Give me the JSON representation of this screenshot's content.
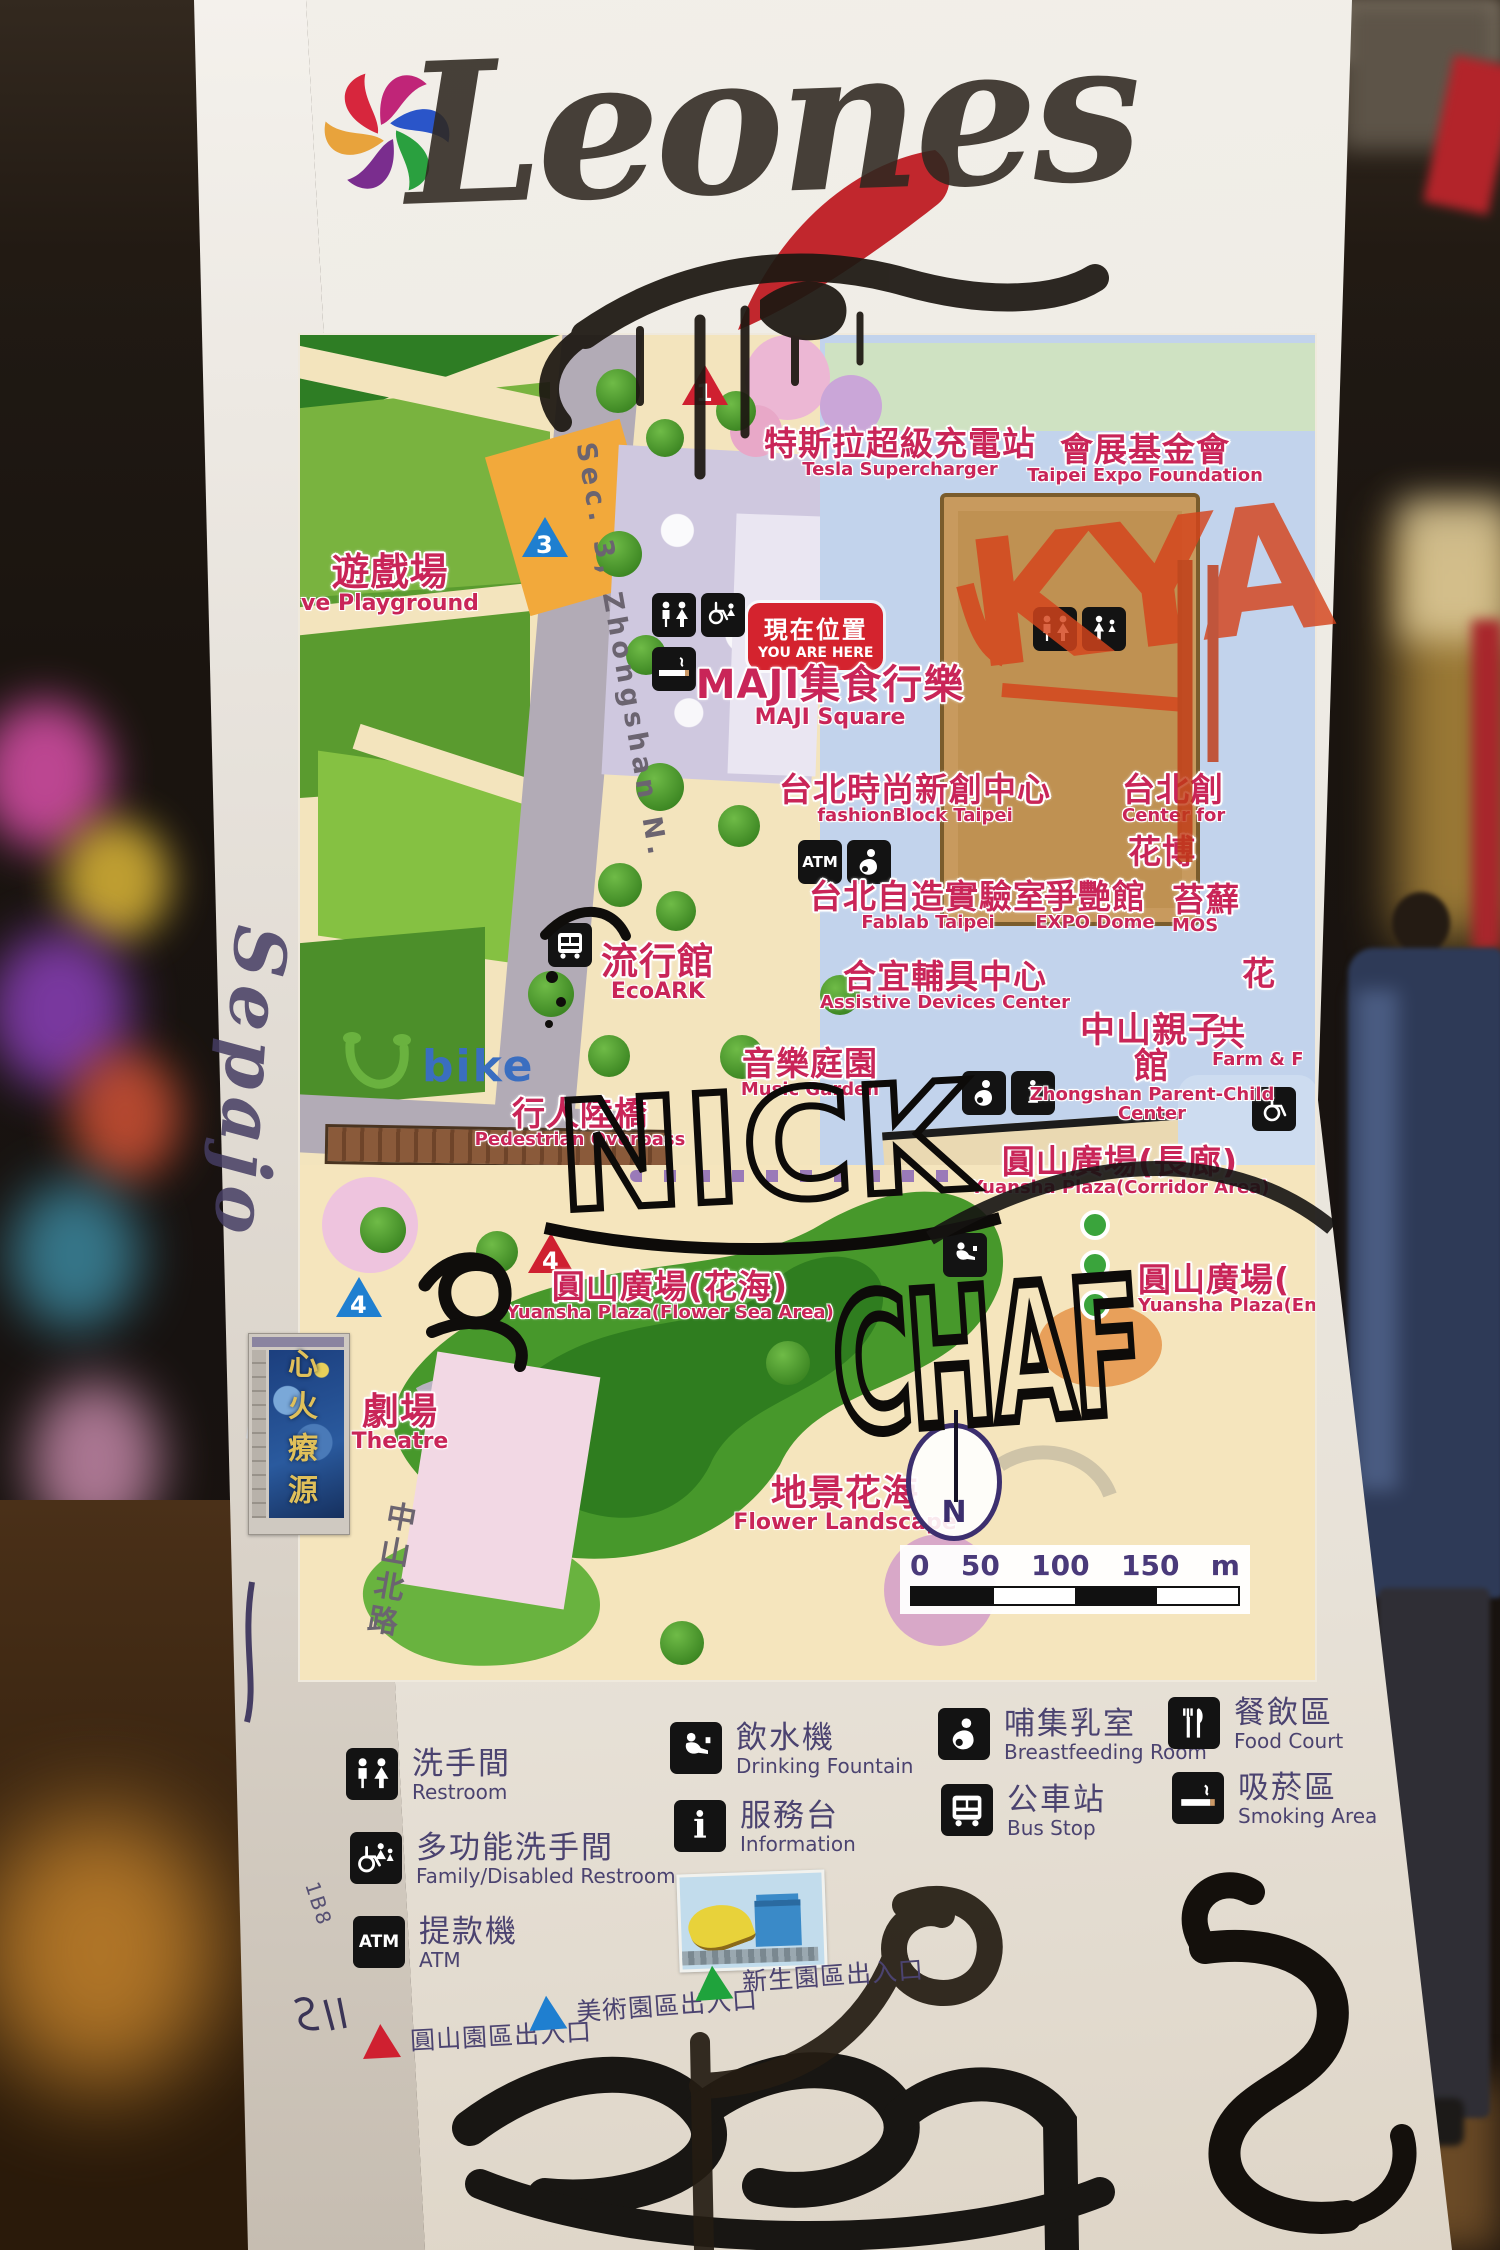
{
  "scene": {
    "subject": "Park information map sign on a white pillar with graffiti",
    "graffiti": {
      "top_tag": "Leones",
      "red_tag": "KYA",
      "black_tag_1": "NICK",
      "black_tag_2": "CHAF",
      "side_tag": "Sepajo",
      "pillar_code": "1B8"
    }
  },
  "logo": {
    "name": "Taipei Expo Park flower logo",
    "petal_colors": [
      "#e8a33c",
      "#d7263d",
      "#c02578",
      "#2a55c9",
      "#2aa03f",
      "#7a2d8e"
    ]
  },
  "map": {
    "you_are_here": {
      "zh": "現在位置",
      "en": "YOU ARE HERE"
    },
    "roads": {
      "sec3": "Sec. 3, Zhongshan N.",
      "zhongshan_n_rd": "中山北路"
    },
    "ubike_label": "bike",
    "compass_label": "N",
    "scale": {
      "ticks": [
        "0",
        "50",
        "100",
        "150"
      ],
      "unit": "m"
    },
    "markers": [
      {
        "num": "1",
        "color": "#cf2030"
      },
      {
        "num": "3",
        "color": "#1f7fd0"
      },
      {
        "num": "4",
        "color": "#cf2030"
      },
      {
        "num": "4",
        "color": "#1f7fd0"
      }
    ],
    "labels": [
      {
        "id": "playground",
        "zh": "遊戲場",
        "en": "ve Playground"
      },
      {
        "id": "tesla-supercharger",
        "zh": "特斯拉超級充電站",
        "en": "Tesla Supercharger"
      },
      {
        "id": "expo-foundation",
        "zh": "會展基金會",
        "en": "Taipei Expo Foundation"
      },
      {
        "id": "maji-square",
        "zh": "MAJI集食行樂",
        "en": "MAJI Square"
      },
      {
        "id": "fashionblock",
        "zh": "台北時尚新創中心",
        "en": "fashionBlock Taipei"
      },
      {
        "id": "center-for",
        "zh": "台北創",
        "en": "Center for"
      },
      {
        "id": "expo-hall",
        "zh": "花博",
        "en": ""
      },
      {
        "id": "fablab",
        "zh": "台北自造實驗室",
        "en": "Fablab Taipei"
      },
      {
        "id": "expo-dome",
        "zh": "爭艷館",
        "en": "EXPO Dome"
      },
      {
        "id": "moss",
        "zh": "苔蘚",
        "en": "MOS"
      },
      {
        "id": "assistive-devices",
        "zh": "合宜輔具中心",
        "en": "Assistive Devices Center"
      },
      {
        "id": "flower",
        "zh": "花",
        "en": ""
      },
      {
        "id": "farm",
        "zh": "共",
        "en": "Farm & F"
      },
      {
        "id": "zhongshan-parent-child",
        "zh": "中山親子館",
        "en": "Zhongshan Parent-Child Center"
      },
      {
        "id": "ecoark",
        "zh": "流行館",
        "en": "EcoARK"
      },
      {
        "id": "music-garden",
        "zh": "音樂庭園",
        "en": "Music Garden"
      },
      {
        "id": "pedestrian-overpass",
        "zh": "行人陸橋",
        "en": "Pedestrian Overpass"
      },
      {
        "id": "corridor-plaza",
        "zh": "圓山廣場(長廊)",
        "en": "Yuansha Plaza(Corridor Area)"
      },
      {
        "id": "flower-sea-plaza",
        "zh": "圓山廣場(花海)",
        "en": "Yuansha Plaza(Flower Sea Area)"
      },
      {
        "id": "entrance-plaza",
        "zh": "圓山廣場(",
        "en": "Yuansha Plaza(Entra"
      },
      {
        "id": "theatre",
        "zh": "劇場",
        "en": "Theatre"
      },
      {
        "id": "flower-landscape",
        "zh": "地景花海",
        "en": "Flower Landscape"
      }
    ]
  },
  "legend": {
    "items": [
      {
        "zh": "洗手間",
        "en": "Restroom",
        "icon": "restroom-icon"
      },
      {
        "zh": "多功能洗手間",
        "en": "Family/Disabled Restroom",
        "icon": "accessible-restroom-icon"
      },
      {
        "zh": "提款機",
        "en": "ATM",
        "icon": "atm-icon"
      },
      {
        "zh": "飲水機",
        "en": "Drinking Fountain",
        "icon": "drinking-fountain-icon"
      },
      {
        "zh": "服務台",
        "en": "Information",
        "icon": "information-icon"
      },
      {
        "zh": "哺集乳室",
        "en": "Breastfeeding Room",
        "icon": "breastfeeding-icon"
      },
      {
        "zh": "公車站",
        "en": "Bus Stop",
        "icon": "bus-icon"
      },
      {
        "zh": "餐飲區",
        "en": "Food Court",
        "icon": "food-court-icon"
      },
      {
        "zh": "吸菸區",
        "en": "Smoking Area",
        "icon": "smoking-icon"
      }
    ],
    "atm_icon_text": "ATM",
    "info_icon_text": "i",
    "entrances": [
      {
        "zh": "圓山園區出入口",
        "color": "#cf2030"
      },
      {
        "zh": "美術園區出入口",
        "color": "#1f7fd0"
      },
      {
        "zh": "新生園區出入口",
        "color": "#1fa33c"
      }
    ]
  },
  "stickers": {
    "starry_night_text": "心火療源",
    "banana_sticker": "banana and castle drawing"
  },
  "colors": {
    "label_pink": "#c92558",
    "legend_text": "#4b4370",
    "map_cream": "#f3e4bd",
    "park_green": "#79b33f",
    "road_gray": "#b2abb6",
    "ring_blue": "#c2d3ec",
    "dome_tan": "#bf9152",
    "pillar_white": "#edeae3"
  }
}
